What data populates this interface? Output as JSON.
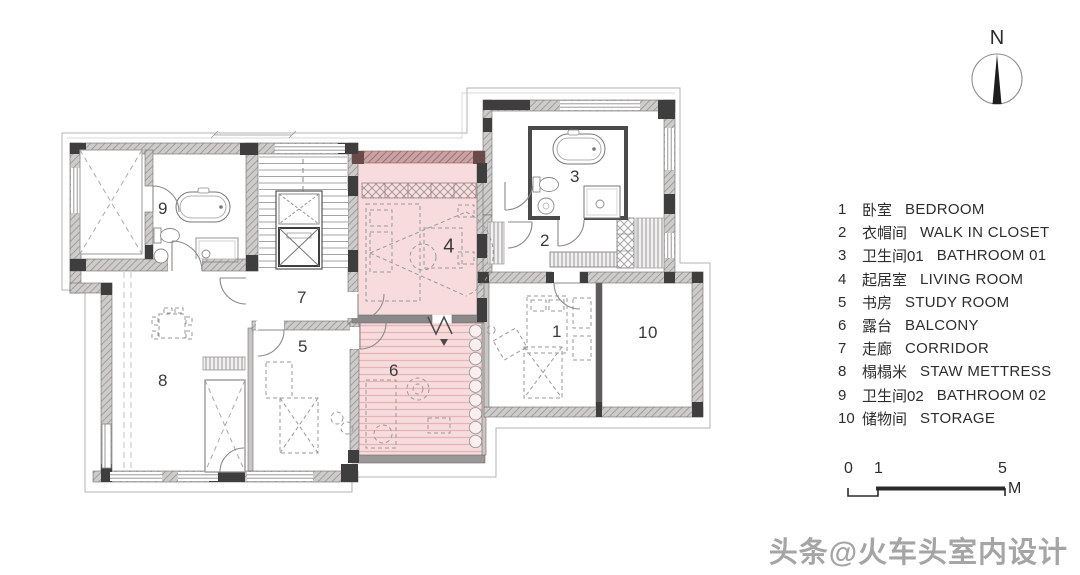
{
  "legend": {
    "items": [
      {
        "num": "1",
        "zh": "卧室",
        "en": "BEDROOM"
      },
      {
        "num": "2",
        "zh": "衣帽间",
        "en": "WALK IN CLOSET"
      },
      {
        "num": "3",
        "zh": "卫生间01",
        "en": "BATHROOM 01"
      },
      {
        "num": "4",
        "zh": "起居室",
        "en": "LIVING ROOM"
      },
      {
        "num": "5",
        "zh": "书房",
        "en": "STUDY ROOM"
      },
      {
        "num": "6",
        "zh": "露台",
        "en": "BALCONY"
      },
      {
        "num": "7",
        "zh": "走廊",
        "en": "CORRIDOR"
      },
      {
        "num": "8",
        "zh": "榻榻米",
        "en": "STAW METTRESS"
      },
      {
        "num": "9",
        "zh": "卫生间02",
        "en": "BATHROOM 02"
      },
      {
        "num": "10",
        "zh": "储物间",
        "en": "STORAGE"
      }
    ]
  },
  "compass": {
    "label": "N"
  },
  "scale": {
    "ticks": [
      "0",
      "1",
      "5"
    ],
    "unit": "M"
  },
  "watermark": {
    "text": "头条@火车头室内设计"
  },
  "plan": {
    "highlighted_room_numbers": [
      "4",
      "6"
    ],
    "colors": {
      "highlight_pink": "#f8dcdd",
      "highlight_stripe": "#e6b3b6",
      "wall_dark": "#3f3e3e",
      "wall_gray": "#cecbcb"
    }
  }
}
